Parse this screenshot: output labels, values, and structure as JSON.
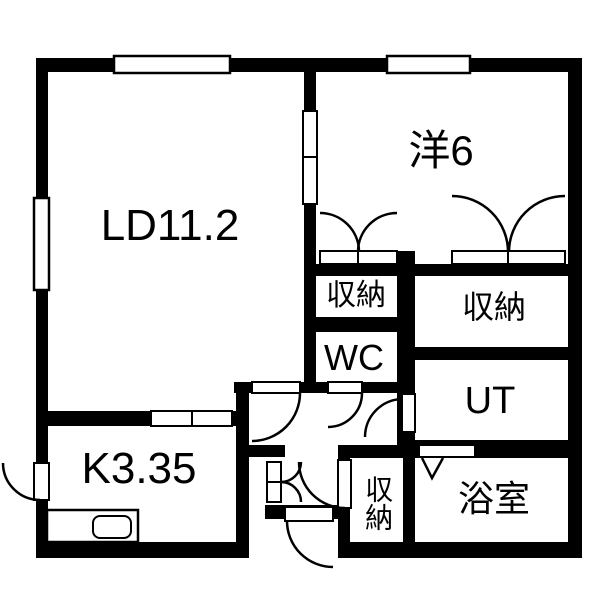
{
  "floorplan": {
    "background": "#ffffff",
    "wall_color": "#000000",
    "rooms": {
      "ld": {
        "label": "LD11.2"
      },
      "western": {
        "label": "洋6"
      },
      "closet_upper": {
        "label": "収納"
      },
      "wc": {
        "label": "WC"
      },
      "closet_right": {
        "label": "収納"
      },
      "ut": {
        "label": "UT"
      },
      "bath": {
        "label": "浴室"
      },
      "kitchen": {
        "label": "K3.35"
      },
      "closet_lower": {
        "label": "収納"
      }
    }
  }
}
